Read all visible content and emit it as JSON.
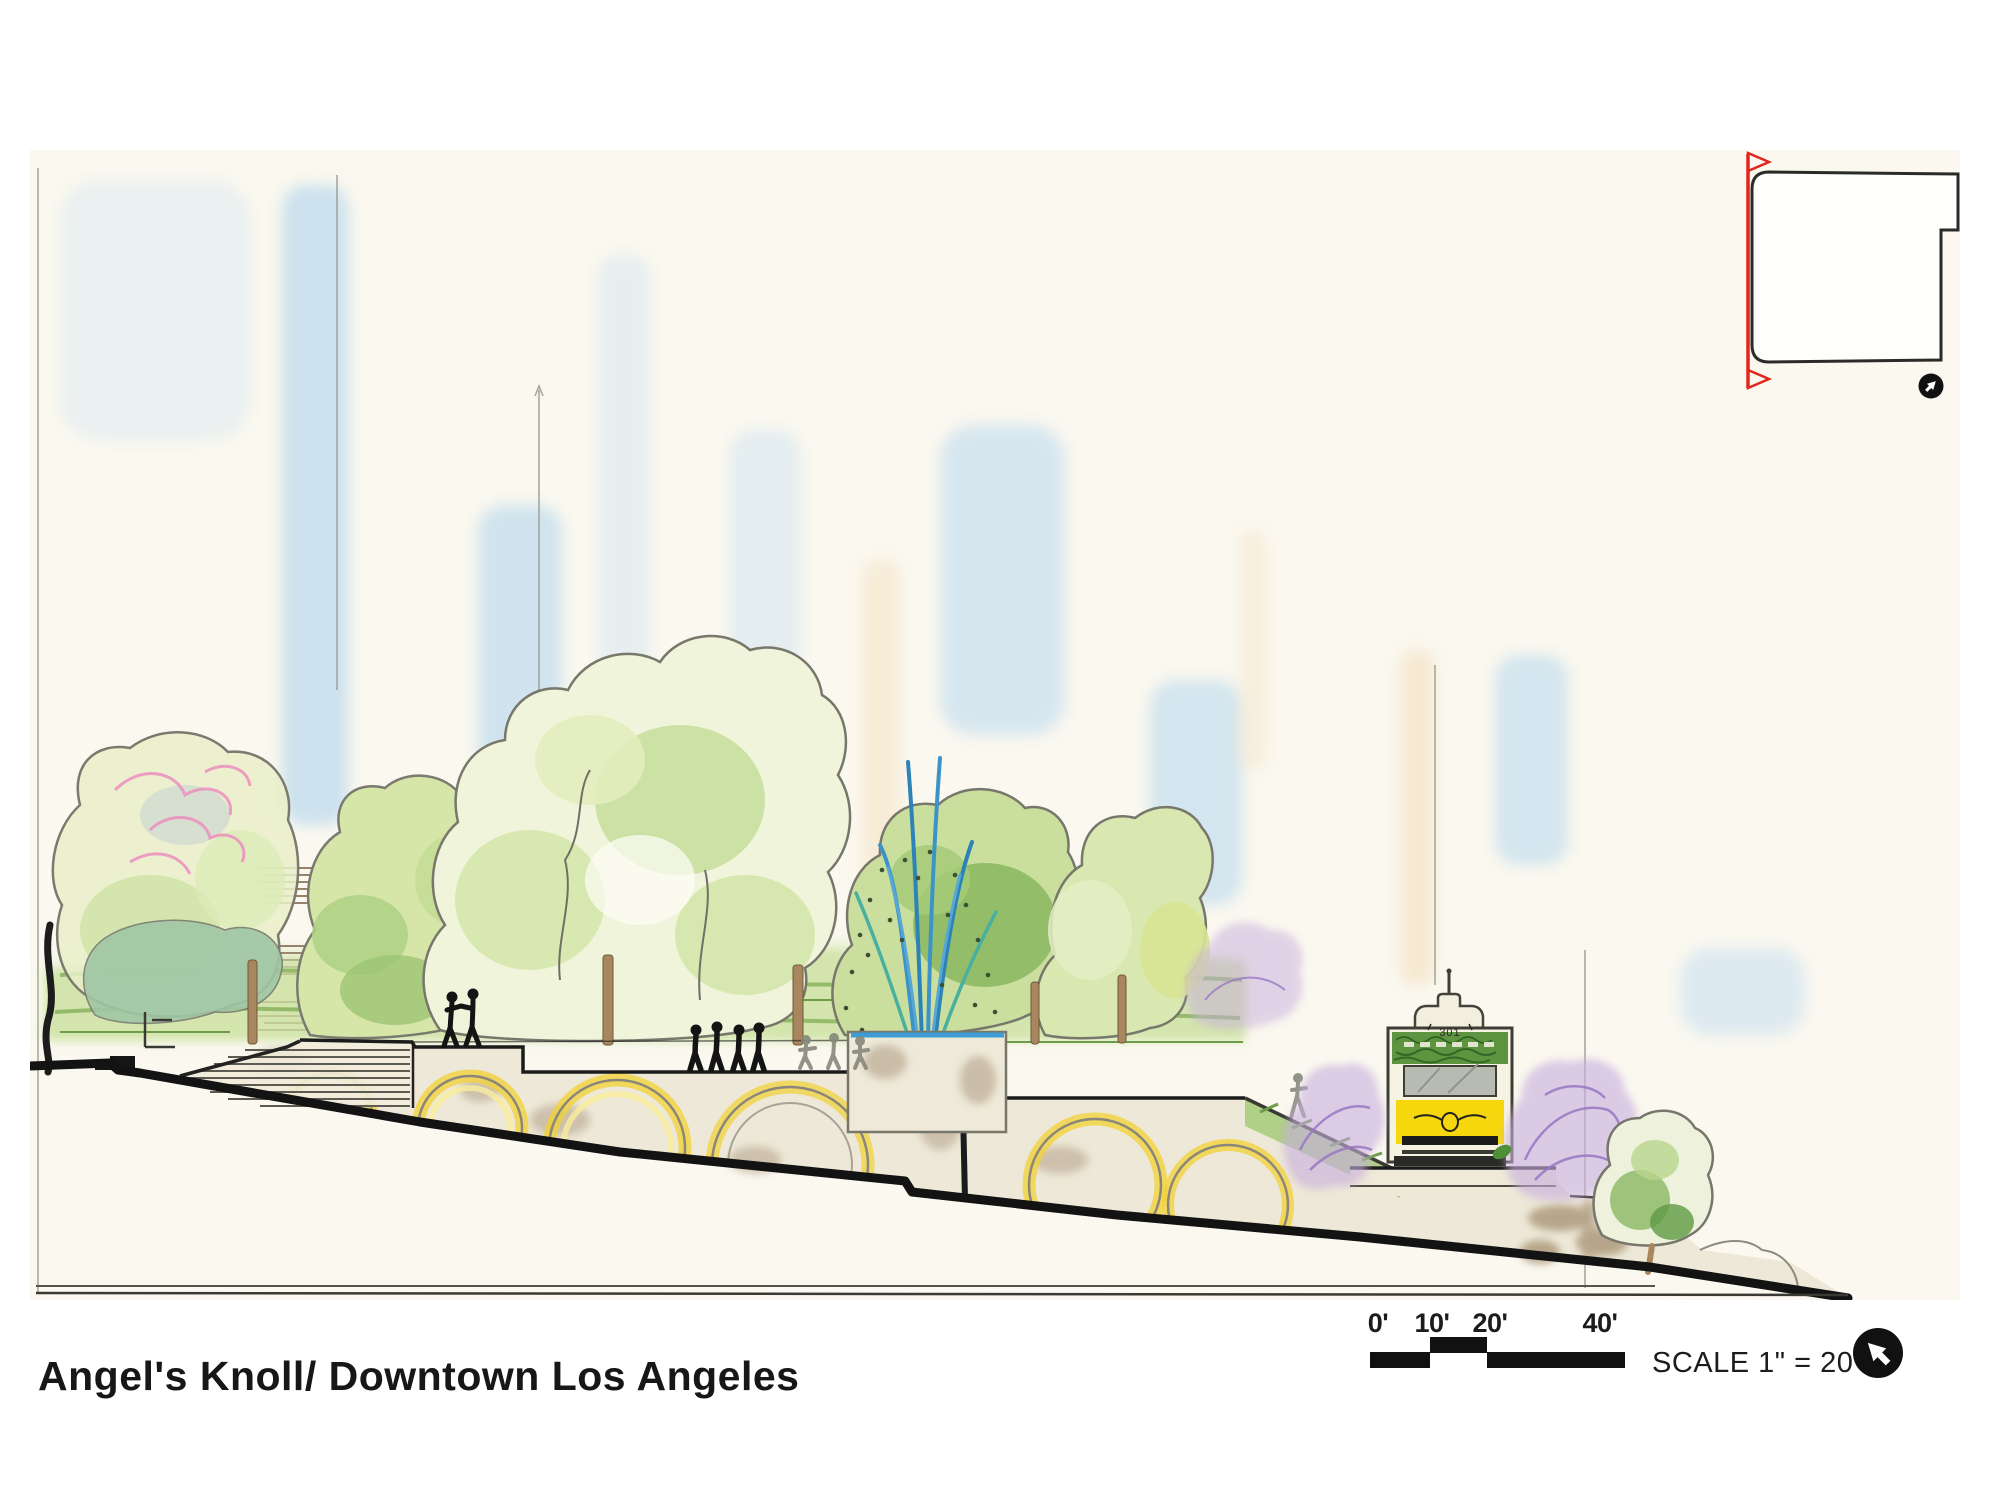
{
  "page": {
    "background_color": "#ffffff",
    "paper_color": "#faf8ef",
    "type": "landscape-architecture-section-drawing"
  },
  "title": "Angel's Knoll/ Downtown Los Angeles",
  "scale_bar": {
    "labels": [
      "0'",
      "10'",
      "20'",
      "40'"
    ],
    "note": "SCALE 1\" = 20'-0\""
  },
  "funicular": {
    "car_number": "301"
  },
  "key_plan": {
    "section_marker_color": "#e1261d"
  },
  "icons": {
    "north_arrow_bottom": "north-arrow-icon",
    "north_arrow_key_plan": "north-arrow-icon"
  },
  "palette": {
    "ink": "#161616",
    "pen_gray": "#77776c",
    "arch_yellow": "#f1d133",
    "tram_yellow": "#f6d70e",
    "tram_green": "#5d9440",
    "wash_blue": "#bcd9f2",
    "wash_green": "#cde2a2",
    "wash_purple": "#c7aede",
    "blossom_pink": "#ec8fc0",
    "wall_beige": "#ece7d5"
  }
}
